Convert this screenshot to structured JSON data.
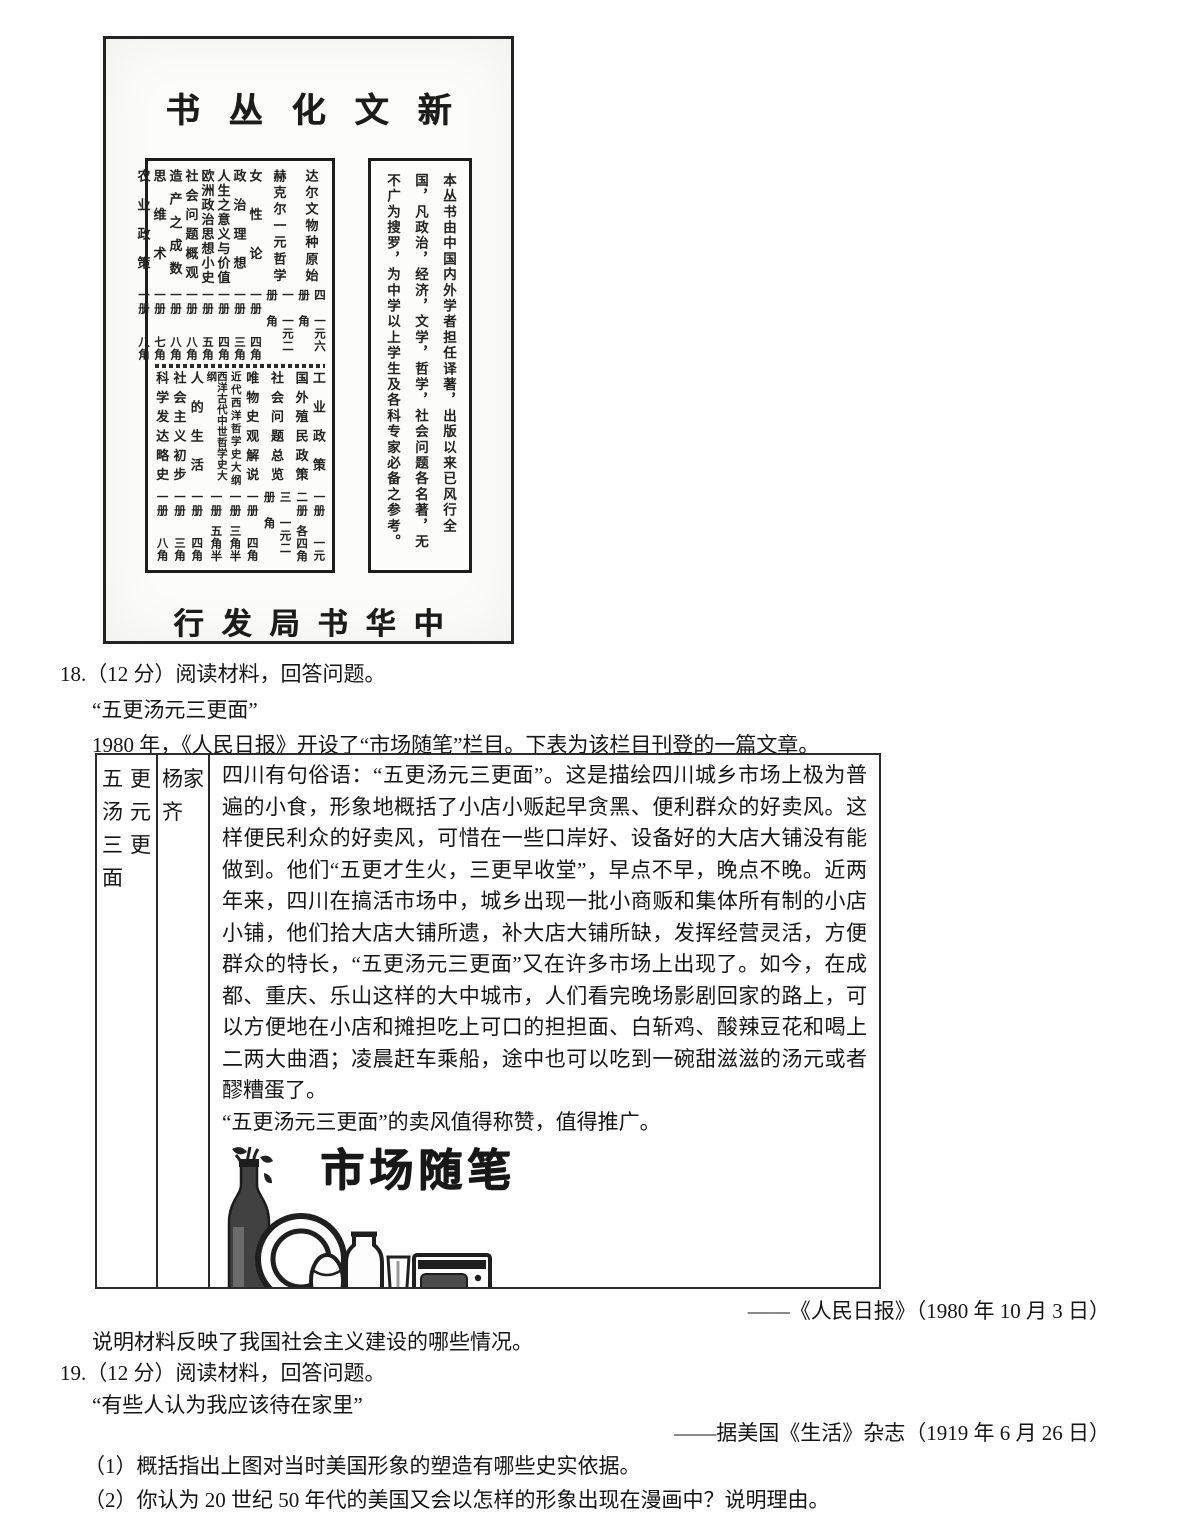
{
  "colors": {
    "ink": "#151515",
    "paper": "#ffffff"
  },
  "ad": {
    "series_title": "书丛化文新",
    "publisher": "行发局书华中",
    "blurb": "本丛书由中国内外学者担任译著，出版以来已风行全国，凡政治，经济，文学，哲学，社会问题各名著，无不广为搜罗，为中学以上学生及各科专家必备之参考。",
    "books_upper": [
      {
        "title": "达尔文物种原始",
        "vols": "四册",
        "price": "一元六角"
      },
      {
        "title": "赫克尔一元哲学",
        "vols": "一册",
        "price": "一元二角"
      },
      {
        "title": "女性论",
        "vols": "一册",
        "price": "四角"
      },
      {
        "title": "政治理想",
        "vols": "一册",
        "price": "三角"
      },
      {
        "title": "人生之意义与价值",
        "vols": "一册",
        "price": "四角"
      },
      {
        "title": "欧洲政治思想小史",
        "vols": "一册",
        "price": "五角"
      },
      {
        "title": "社会问题概观",
        "vols": "一册",
        "price": "八角"
      },
      {
        "title": "造产之成数",
        "vols": "一册",
        "price": "八角"
      },
      {
        "title": "思维术",
        "vols": "一册",
        "price": "七角"
      },
      {
        "title": "农业政策",
        "vols": "一册",
        "price": "八角"
      }
    ],
    "books_lower": [
      {
        "title": "工业政策",
        "vols": "一册",
        "price": "一元"
      },
      {
        "title": "国外殖民政策",
        "vols": "二册",
        "price": "各四角"
      },
      {
        "title": "社会问题总览",
        "vols": "三册",
        "price": "一元二角"
      },
      {
        "title": "唯物史观解说",
        "vols": "一册",
        "price": "四角"
      },
      {
        "title": "近代西洋哲学史大纲",
        "vols": "一册",
        "price": "三角半"
      },
      {
        "title": "西洋古代中世哲学史大纲",
        "vols": "一册",
        "price": "五角半"
      },
      {
        "title": "人的生活",
        "vols": "一册",
        "price": "四角"
      },
      {
        "title": "社会主义初步",
        "vols": "一册",
        "price": "三角"
      },
      {
        "title": "科学发达略史",
        "vols": "一册",
        "price": "八角"
      }
    ]
  },
  "q18": {
    "stem": "18.（12 分）阅读材料，回答问题。",
    "subtitle": "“五更汤元三更面”",
    "intro": "1980 年，《人民日报》开设了“市场随笔”栏目。下表为该栏目刊登的一篇文章。",
    "source": "——《人民日报》（1980 年 10 月 3 日）",
    "task": "说明材料反映了我国社会主义建设的哪些情况。"
  },
  "table": {
    "col_title": "五更汤元三更面",
    "col_author": "杨家齐",
    "article_p1": "四川有句俗语：“五更汤元三更面”。这是描绘四川城乡市场上极为普遍的小食，形象地概括了小店小贩起早贪黑、便利群众的好卖风。这样便民利众的好卖风，可惜在一些口岸好、设备好的大店大铺没有能做到。他们“五更才生火，三更早收堂”，早点不早，晚点不晚。近两年来，四川在搞活市场中，城乡出现一批小商贩和集体所有制的小店小铺，他们拾大店大铺所遗，补大店大铺所缺，发挥经营灵活，方便群众的特长，“五更汤元三更面”又在许多市场上出现了。如今，在成都、重庆、乐山这样的大中城市，人们看完晚场影剧回家的路上，可以方便地在小店和摊担吃上可口的担担面、白斩鸡、酸辣豆花和喝上二两大曲酒；凌晨赶车乘船，途中也可以吃到一碗甜滋滋的汤元或者醪糟蛋了。",
    "article_p2": "“五更汤元三更面”的卖风值得称赞，值得推广。",
    "logo_text": "市场随笔"
  },
  "q19": {
    "stem": "19.（12 分）阅读材料，回答问题。",
    "subtitle": "“有些人认为我应该待在家里”",
    "source": "——据美国《生活》杂志（1919 年 6 月 26 日）",
    "sub1": "（1）概括指出上图对当时美国形象的塑造有哪些史实依据。",
    "sub2": "（2）你认为 20 世纪 50 年代的美国又会以怎样的形象出现在漫画中？说明理由。"
  }
}
